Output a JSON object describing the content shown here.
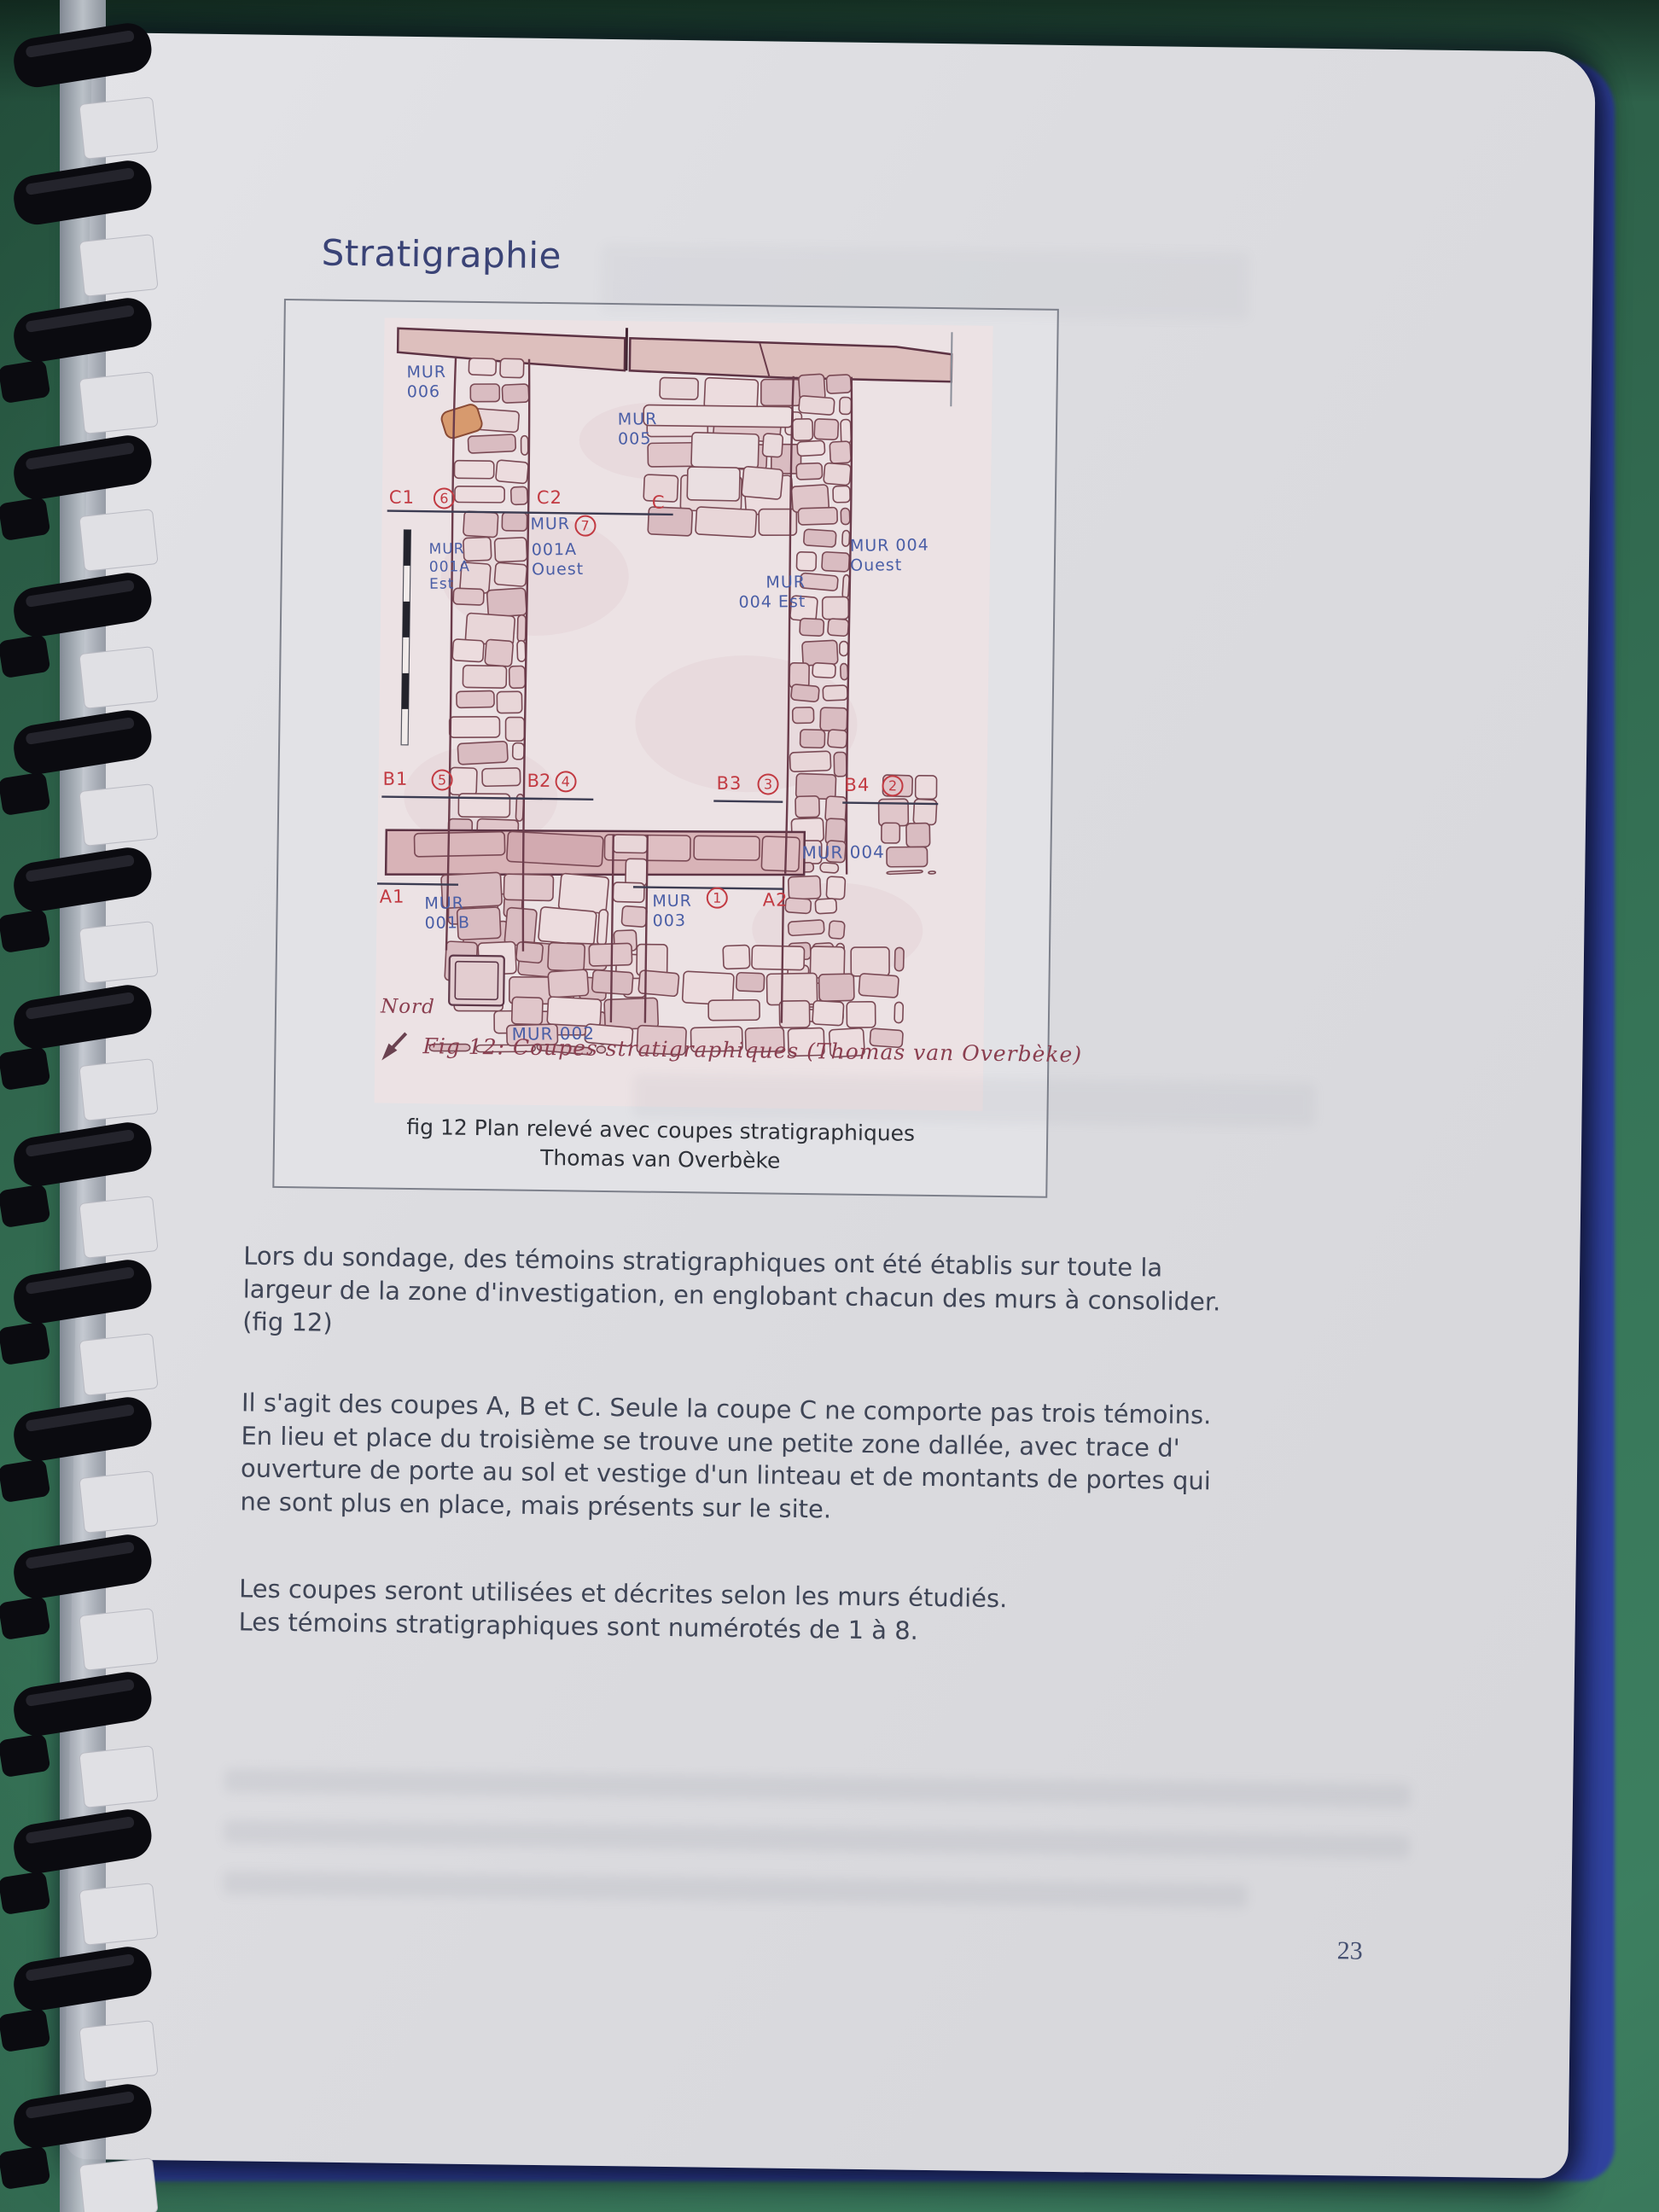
{
  "doc": {
    "title": "Stratigraphie",
    "page_number": "23"
  },
  "figure": {
    "caption_line1": "fig 12 Plan relevé avec coupes stratigraphiques",
    "caption_line2": "Thomas van Overbèke",
    "hand_caption": "Fig 12:  Coupes stratigraphiques (Thomas van Overbèke)",
    "north_label": "Nord"
  },
  "plan": {
    "mur006": "MUR\n006",
    "mur005": "MUR\n005",
    "c1": "C1",
    "n6": "6",
    "c2": "C2",
    "c": "C",
    "mur": "MUR",
    "n7": "7",
    "a001a_ouest": "001A\nOuest",
    "mur001a_est": "MUR\n001A\nEst",
    "mur004_ouest": "MUR 004\nOuest",
    "mur004_est": "MUR\n004 Est",
    "b1": "B1",
    "n5": "5",
    "b2": "B2",
    "n4": "4",
    "b3": "B3",
    "n3": "3",
    "b4": "B4",
    "n2": "2",
    "mur004": "MUR 004",
    "a1": "A1",
    "mur001b": "MUR\n001B",
    "mur003": "MUR\n003",
    "n1": "1",
    "a2": "A2",
    "mur002": "MUR 002"
  },
  "body": {
    "para1": "Lors du sondage, des témoins stratigraphiques ont été établis sur toute la\nlargeur de la zone d'investigation, en englobant chacun des murs à consolider.\n(fig 12)",
    "para2": "Il s'agit des coupes A, B et C. Seule la coupe C ne comporte pas trois témoins.\nEn lieu et place du troisième se trouve une petite zone dallée, avec trace d'\nouverture de porte au sol et vestige d'un linteau et de montants de portes qui\nne sont plus en place, mais présents sur le site.",
    "para3": "Les coupes seront utilisées et décrites selon les murs étudiés.\nLes témoins stratigraphiques sont numérotés de 1 à 8."
  },
  "colors": {
    "ink_blue": "#4a5ea6",
    "ink_red": "#c23a42",
    "ink_maroon": "#8a3f50",
    "title_navy": "#3a4376",
    "body_text": "#3f4556",
    "mat_green": "#35775a",
    "page_gray": "#dcdce0",
    "stone_outline": "#7a4a55",
    "stone_fill": "#e0c6ca"
  }
}
